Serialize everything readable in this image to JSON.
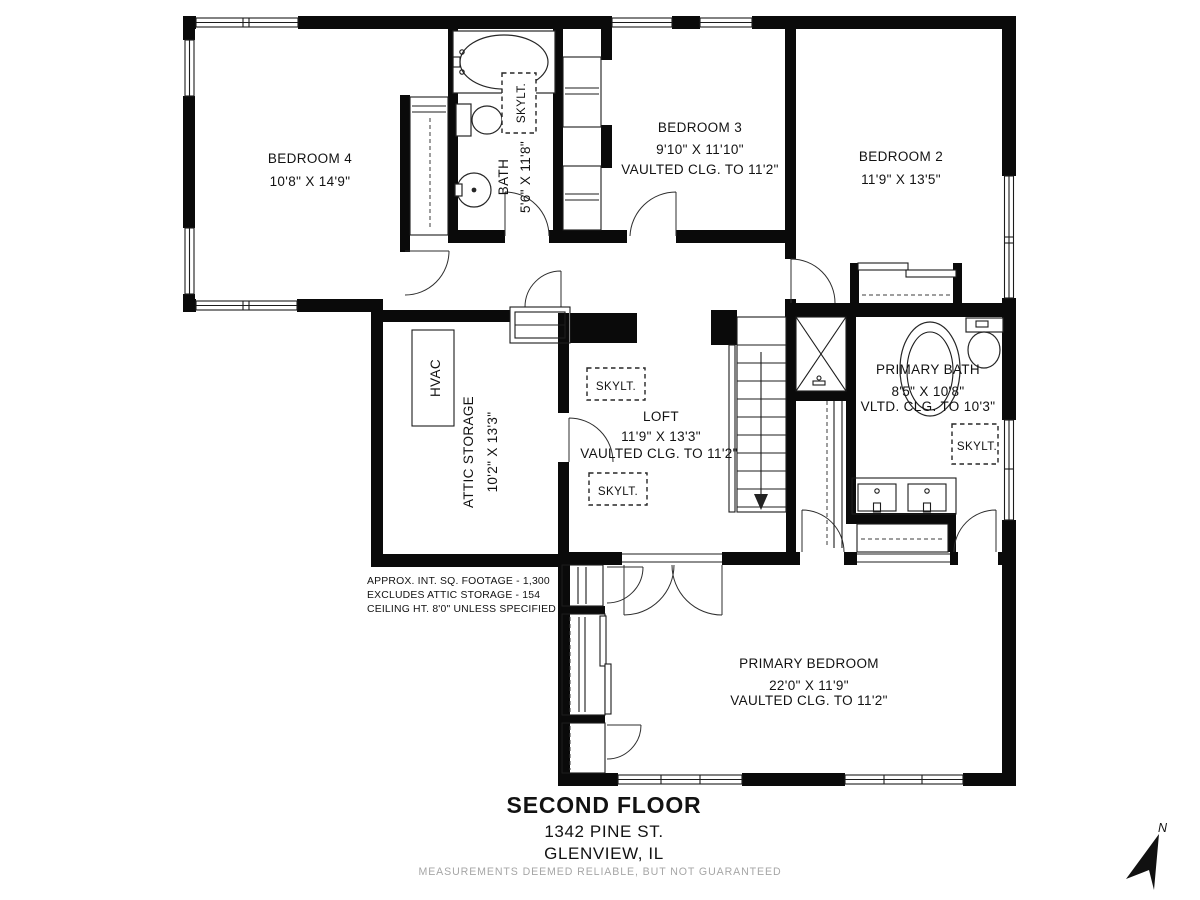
{
  "title_block": {
    "floor": "SECOND FLOOR",
    "address": "1342 PINE ST.",
    "city": "GLENVIEW, IL"
  },
  "disclaimer": "MEASUREMENTS DEEMED RELIABLE, BUT NOT GUARANTEED",
  "compass": {
    "north": "N"
  },
  "notes": {
    "line1": "APPROX. INT. SQ. FOOTAGE - 1,300",
    "line2": "EXCLUDES ATTIC STORAGE - 154",
    "line3": "CEILING HT. 8'0\" UNLESS SPECIFIED"
  },
  "labels": {
    "skylight": "SKYLT."
  },
  "rooms": {
    "bedroom4": {
      "name": "BEDROOM 4",
      "dims": "10'8\" X 14'9\""
    },
    "bath": {
      "name": "BATH",
      "dims": "5'6\" X 11'8\""
    },
    "bedroom3": {
      "name": "BEDROOM 3",
      "dims": "9'10\" X 11'10\"",
      "ceiling": "VAULTED CLG. TO 11'2\""
    },
    "bedroom2": {
      "name": "BEDROOM 2",
      "dims": "11'9\" X 13'5\""
    },
    "hvac": {
      "name": "HVAC"
    },
    "attic": {
      "name": "ATTIC STORAGE",
      "dims": "10'2\" X 13'3\""
    },
    "loft": {
      "name": "LOFT",
      "dims": "11'9\" X 13'3\"",
      "ceiling": "VAULTED CLG. TO 11'2\""
    },
    "primary_bath": {
      "name": "PRIMARY BATH",
      "dims": "8'5\" X 10'8\"",
      "ceiling": "VLTD. CLG. TO 10'3\""
    },
    "primary_bedroom": {
      "name": "PRIMARY BEDROOM",
      "dims": "22'0\" X 11'9\"",
      "ceiling": "VAULTED CLG. TO 11'2\""
    }
  }
}
